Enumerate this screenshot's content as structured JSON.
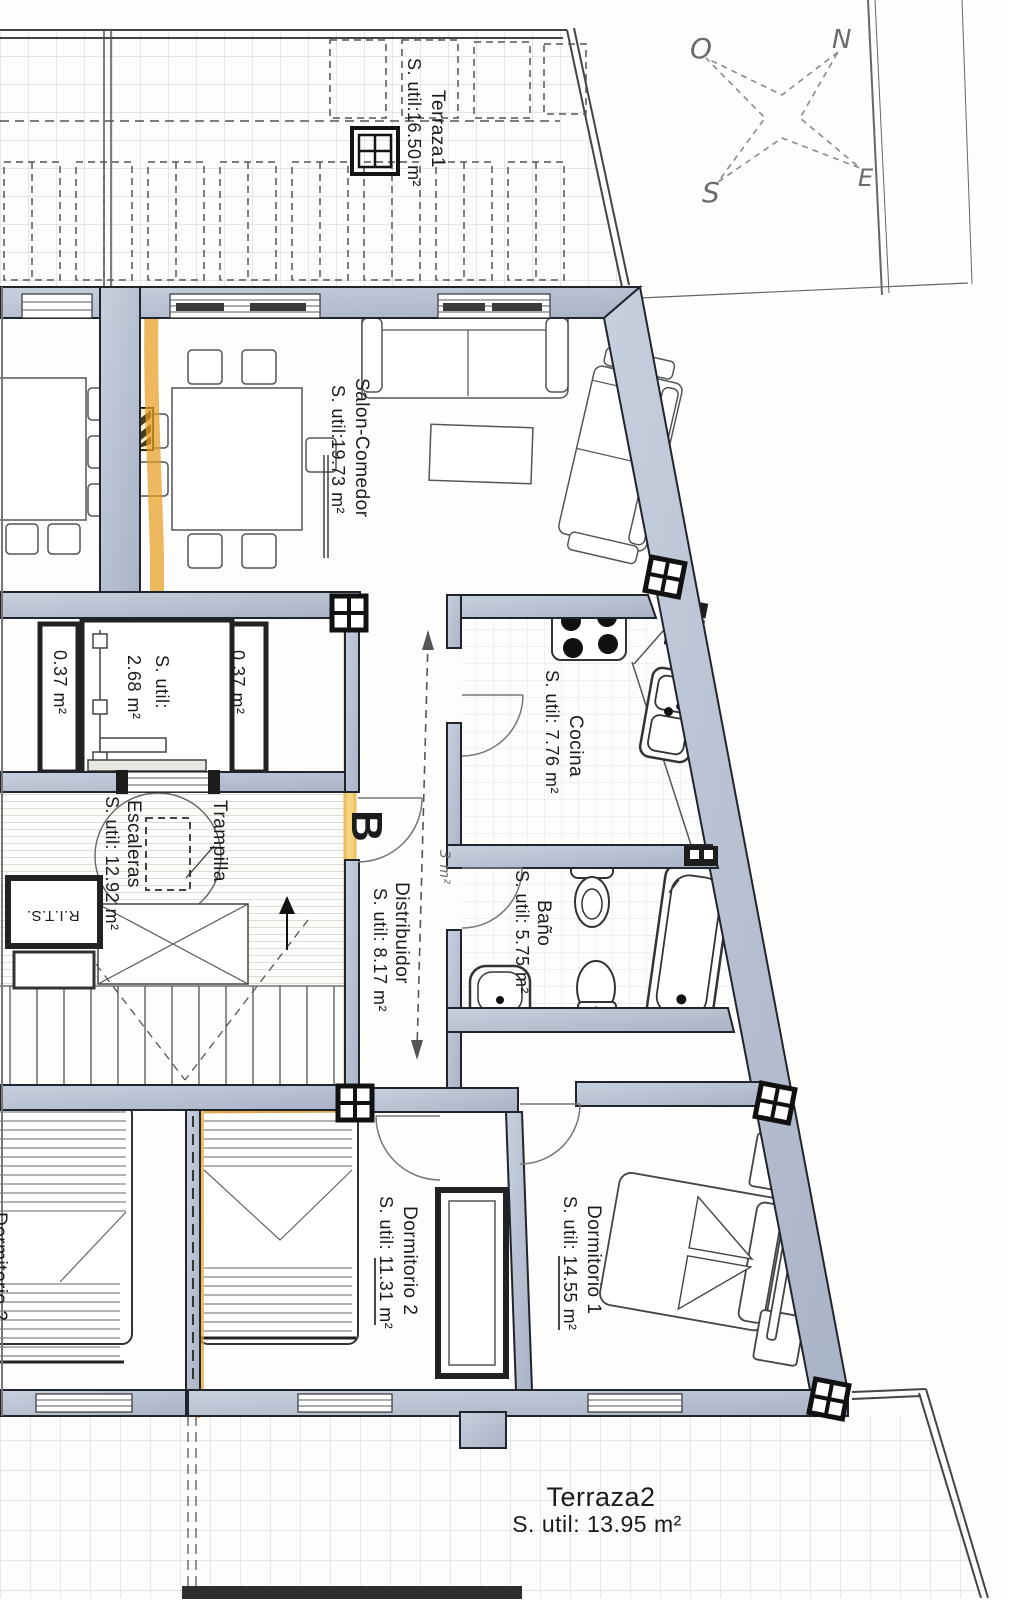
{
  "labels": {
    "terraza1": {
      "name": "Terraza1",
      "area": "S. util:16.50 m²"
    },
    "salon": {
      "name": "Salon-Comedor",
      "area": "S. util:19.73 m²"
    },
    "trastero": {
      "name": "S. util:",
      "area": "2.68 m²"
    },
    "shaft_left": {
      "area": "0.37 m²"
    },
    "shaft_right": {
      "area": "0.37 m²"
    },
    "escaleras": {
      "name": "Escaleras",
      "area": "S. util: 12.92 m²"
    },
    "trampilla": {
      "name": "Trampilla"
    },
    "rits": {
      "name": "R.I.T.S."
    },
    "portal": {
      "name": "B"
    },
    "distribuidor": {
      "name": "Distribuidor",
      "area": "S. util: 8.17 m²"
    },
    "cocina": {
      "name": "Cocina",
      "area": "S. util: 7.76 m²"
    },
    "bano": {
      "name": "Baño",
      "area": "S. util: 5.75 m²"
    },
    "dormitorio1": {
      "name": "Dormitorio 1",
      "area": "S. util: 14.55 m²"
    },
    "dormitorio2": {
      "name": "Dormitorio 2",
      "area": "S. util: 11.31 m²"
    },
    "dormitorio2_vecino": {
      "name": "Dormitorio 2"
    },
    "terraza2": {
      "name": "Terraza2",
      "area": "S. util: 13.95 m²"
    }
  },
  "compass": {
    "n": "N",
    "o": "O",
    "s": "S",
    "e": "E"
  },
  "annotations": {
    "handwritten_note": "3 m²"
  },
  "colors": {
    "wall_fill": "#b9c3d4",
    "wall_edge": "#20242c",
    "highlighter": "#e79d23",
    "highlighter_light": "#f4c64f",
    "terrace_grid": "#c8d1dc",
    "tile_grid": "#dfe4ec"
  }
}
